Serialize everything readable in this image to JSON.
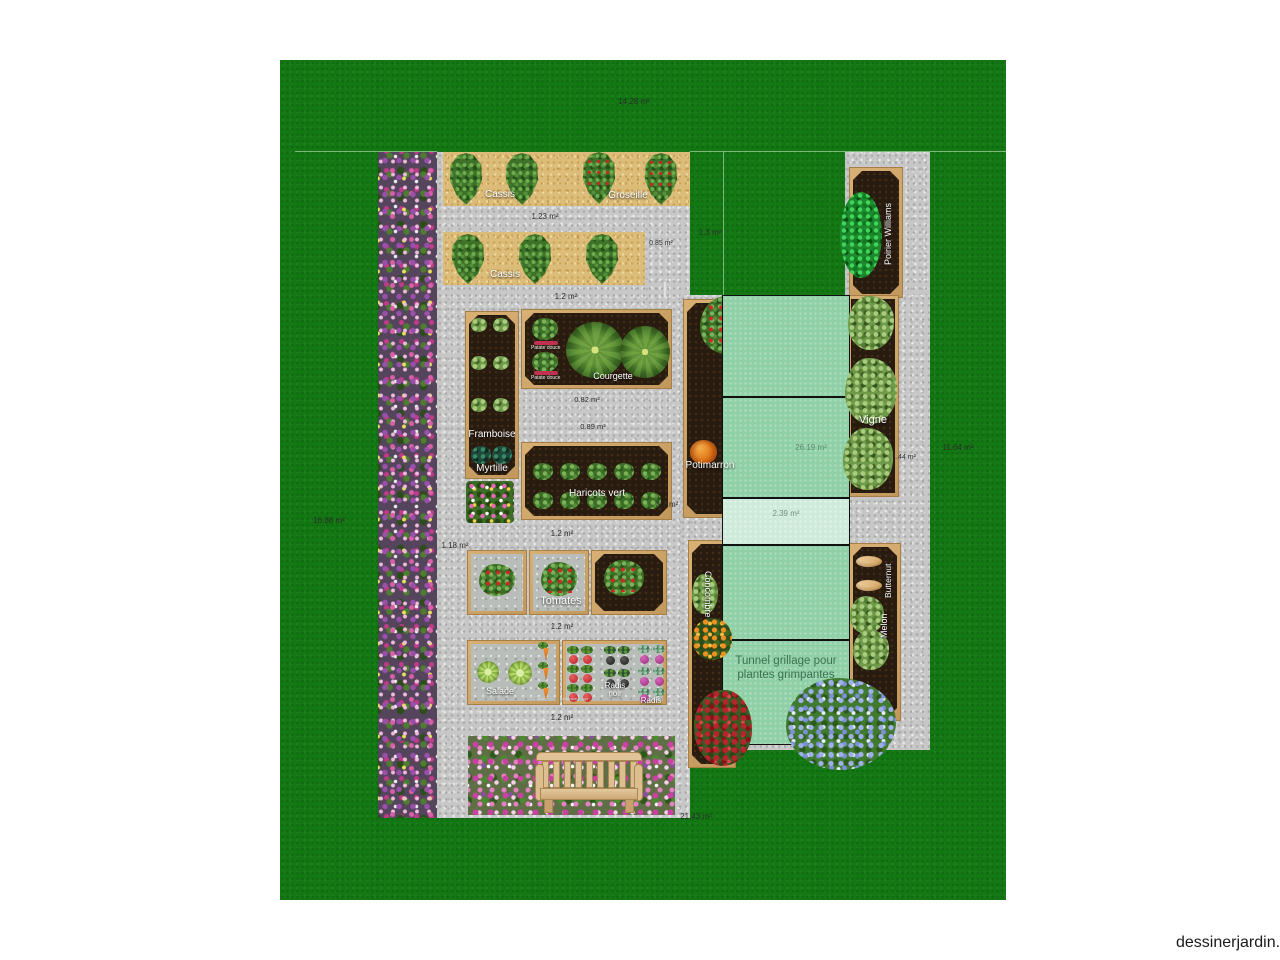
{
  "watermark": "dessinerjardin.fr",
  "labels": {
    "lawn_top": "14.28 m²",
    "lawn_right": "11.64 m²",
    "lawn_left": "16.88 m²",
    "lawn_small": "1,3 m²",
    "lawn_bottom": "21,43 m²",
    "row1_path": "1.23 m²",
    "row2_right": "0.85 m²",
    "path_a": "1.2 m²",
    "courgette_a": "0.82 m²",
    "courgette_b": "0.89 m²",
    "haricots_right": "3.7 m²",
    "path_b": "1.2 m²",
    "tomatoes_left": "1.18 m²",
    "path_c": "1.2 m²",
    "path_d": "1.2 m²",
    "vigne_right": "1.44 m²",
    "tunnel_big": "26.19 m²",
    "tunnel_strip": "2.39 m²"
  },
  "beds": {
    "cassis1": "Cassis",
    "groseille": "Groseille",
    "cassis2": "Cassis",
    "framboise": "Framboise",
    "myrtille": "Myrtille",
    "patate_douce_top": "Patate douce",
    "patate_douce_bottom": "Patate douce",
    "courgette": "Courgette",
    "haricots_vert": "Haricots vert",
    "tomates": "Tomates",
    "salade": "Salade",
    "carotte": "Carotte",
    "betterave_rouge": "Betterave rouge",
    "radis_noir": "Radis noir",
    "radis": "Radis",
    "potimarron": "Potimarron",
    "poirier_williams": "Poirier Williams",
    "vigne": "Vigne",
    "concombre": "Concombre",
    "butternut": "Butternut",
    "melon": "Melon",
    "tunnel_caption": "Tunnel grillage pour plantes grimpantes"
  }
}
